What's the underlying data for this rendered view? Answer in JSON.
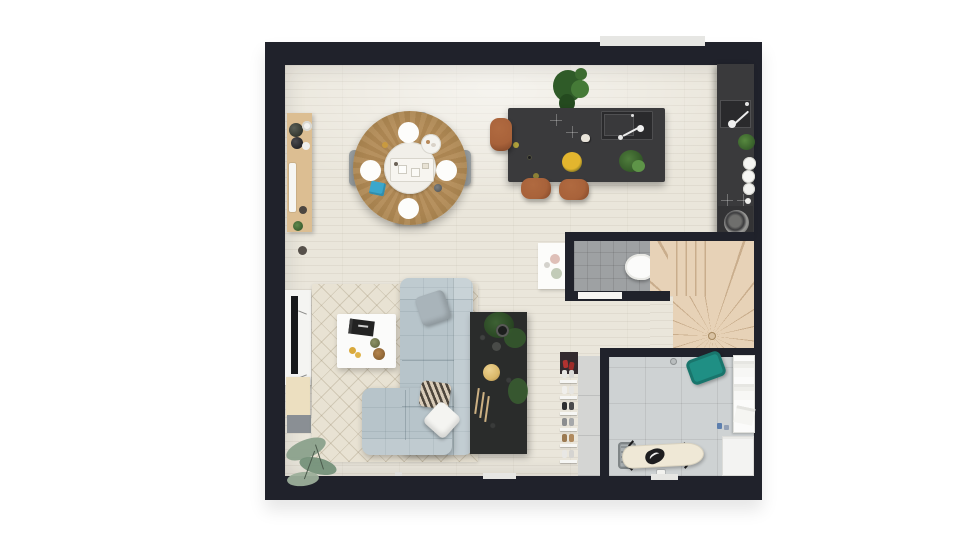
{
  "scene": {
    "kind": "apartment-floor-plan-3d-render",
    "view": "top-down",
    "text_labels": [],
    "rooms": [
      "open-living-dining-kitchen",
      "wc",
      "winder-staircase",
      "utility-laundry-room",
      "entry-corridor"
    ],
    "furniture": [
      "corner-plant",
      "wood-sideboard-with-decor",
      "round-dining-table",
      "dining-chairs-x4",
      "kitchen-island-with-sink-and-hob",
      "bar-stools-x3",
      "wall-counter-with-sink-plates-cooktop",
      "tv-unit-with-tv",
      "cream-cabinet",
      "area-rug",
      "coffee-table",
      "l-shaped-sectional-sofa",
      "throw-pillows-x3",
      "black-console-table-with-plant-and-lamp",
      "floor-plant",
      "toilet",
      "wall-art-panel",
      "winder-stairs",
      "shoe-rack-with-shoes",
      "teal-laundry-basket",
      "linen-shelf",
      "washing-machine",
      "ironing-board-with-iron",
      "gray-laundry-basket",
      "detergent-bottles"
    ]
  },
  "colors": {
    "wall": "#20222b",
    "floor": "#eae6db",
    "kitchen_dark": "#3a3a3c",
    "kitchen_inset": "#2a2a2c",
    "stool_leather": "#a8623a",
    "dining_wood": "#a9844f",
    "platter_white": "#f1efe9",
    "chair_gray": "#9aa0a2",
    "sideboard_wood": "#dcbe92",
    "rug": "#e8e2d3",
    "sofa": "#b7c4ca",
    "pillow_white": "#f4f4f1",
    "console_black": "#2a2c2b",
    "plant_green": "#3c672f",
    "eucalyptus": "#879c88",
    "wc_tile": "#9ea1a3",
    "stair_wood": "#e7d2b7",
    "stair_line": "#c9ad8c",
    "utility_tile": "#ced2d3",
    "teal_basket": "#1f8f84",
    "ironing_board": "#efe8d6",
    "iron_black": "#1d1d1f",
    "white_goods": "#f3f3f2",
    "napkin_blue": "#3ba7cc",
    "fruit_yellow": "#e3b52e",
    "lamp_yellow": "#d9b86a",
    "tv_black": "#17181a",
    "cream_cabinet": "#ecdfc0",
    "window_sill": "#e6e6e3",
    "shoe_red": "#b23230"
  }
}
